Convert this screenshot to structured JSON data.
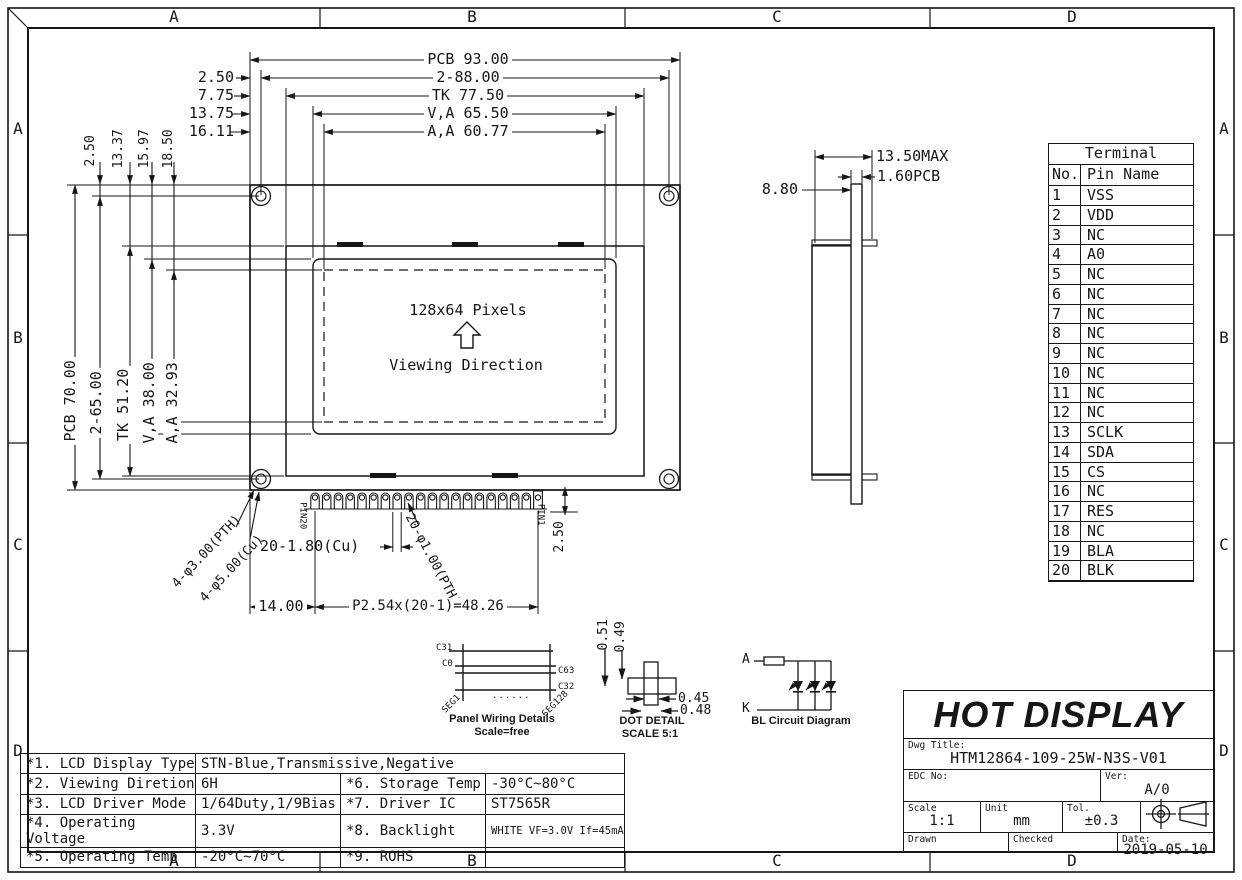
{
  "zones": {
    "top": [
      "A",
      "B",
      "C",
      "D"
    ],
    "bottom": [
      "A",
      "B",
      "C",
      "D"
    ],
    "left": [
      "A",
      "B",
      "C",
      "D"
    ],
    "right": [
      "A",
      "B",
      "C",
      "D"
    ]
  },
  "front_view": {
    "top_dims": [
      "PCB 93.00",
      "2-88.00",
      "TK 77.50",
      "V,A 65.50",
      "A,A 60.77"
    ],
    "top_left_dims": [
      "2.50",
      "7.75",
      "13.75",
      "16.11"
    ],
    "left_top_dims": [
      "2.50",
      "13.37",
      "15.97",
      "18.50"
    ],
    "left_dims": [
      "PCB 70.00",
      "2-65.00",
      "TK 51.20",
      "V,A 38.00",
      "A,A 32.93"
    ],
    "screen_label": "128x64 Pixels",
    "viewing_direction": "Viewing Direction",
    "pin20": "PIN20",
    "pin1": "PIN1",
    "pad_width_dim": "20-1.80(Cu)",
    "pad_hole_dim": "20-φ1.00(PTH)",
    "pin_offset_dim": "14.00",
    "pin_pitch_dim": "P2.54x(20-1)=48.26",
    "pad_drop_dim": "2.50",
    "mount_hole_pth": "4-φ3.00(PTH)",
    "mount_hole_cu": "4-φ5.00(Cu)"
  },
  "side_view": {
    "overall": "13.50MAX",
    "pcb": "1.60PCB",
    "depth": "8.80"
  },
  "terminal": {
    "title": "Terminal",
    "col_no": "No.",
    "col_pin": "Pin Name",
    "rows": [
      {
        "no": "1",
        "pin": "VSS"
      },
      {
        "no": "2",
        "pin": "VDD"
      },
      {
        "no": "3",
        "pin": "NC"
      },
      {
        "no": "4",
        "pin": "A0"
      },
      {
        "no": "5",
        "pin": "NC"
      },
      {
        "no": "6",
        "pin": "NC"
      },
      {
        "no": "7",
        "pin": "NC"
      },
      {
        "no": "8",
        "pin": "NC"
      },
      {
        "no": "9",
        "pin": "NC"
      },
      {
        "no": "10",
        "pin": "NC"
      },
      {
        "no": "11",
        "pin": "NC"
      },
      {
        "no": "12",
        "pin": "NC"
      },
      {
        "no": "13",
        "pin": "SCLK"
      },
      {
        "no": "14",
        "pin": "SDA"
      },
      {
        "no": "15",
        "pin": "CS"
      },
      {
        "no": "16",
        "pin": "NC"
      },
      {
        "no": "17",
        "pin": "RES"
      },
      {
        "no": "18",
        "pin": "NC"
      },
      {
        "no": "19",
        "pin": "BLA"
      },
      {
        "no": "20",
        "pin": "BLK"
      }
    ]
  },
  "panel_wiring": {
    "c31": "C31",
    "c0": "C0",
    "c63": "C63",
    "c32": "C32",
    "dots": "......",
    "seg1": "SEG1",
    "seg128": "SEG128",
    "caption": "Panel Wiring Details",
    "scale": "Scale=free"
  },
  "dot_detail": {
    "h1": "0.51",
    "h2": "0.49",
    "w1": "0.45",
    "w2": "0.48",
    "caption": "DOT DETAIL",
    "scale": "SCALE 5:1"
  },
  "bl_circuit": {
    "anode": "A",
    "cathode": "K",
    "caption": "BL Circuit Diagram"
  },
  "spec_table": {
    "rows": [
      {
        "label": "*1. LCD Display Type",
        "value": "STN-Blue,Transmissive,Negative",
        "label2": "",
        "value2": ""
      },
      {
        "label": "*2. Viewing Diretion",
        "value": "6H",
        "label2": "*6. Storage Temp",
        "value2": "-30°C~80°C"
      },
      {
        "label": "*3. LCD Driver Mode",
        "value": "1/64Duty,1/9Bias",
        "label2": "*7. Driver IC",
        "value2": "ST7565R"
      },
      {
        "label": "*4. Operating Voltage",
        "value": "3.3V",
        "label2": "*8. Backlight",
        "value2": "WHITE VF=3.0V If=45mA"
      },
      {
        "label": "*5. Operating Temp",
        "value": "-20°C~70°C",
        "label2": "*9. ROHS",
        "value2": ""
      }
    ]
  },
  "title_block": {
    "company": "HOT DISPLAY",
    "dwg_title_label": "Dwg Title:",
    "dwg_title": "HTM12864-109-25W-N3S-V01",
    "edc_label": "EDC No:",
    "ver_label": "Ver:",
    "version": "A/0",
    "scale_label": "Scale",
    "scale": "1:1",
    "unit_label": "Unit",
    "unit": "mm",
    "tol_label": "Tol.",
    "tol": "±0.3",
    "drawn_label": "Drawn",
    "checked_label": "Checked",
    "date_label": "Date:",
    "date": "2019-05-10"
  },
  "colors": {
    "line": "#161616",
    "paper": "#ffffff"
  }
}
